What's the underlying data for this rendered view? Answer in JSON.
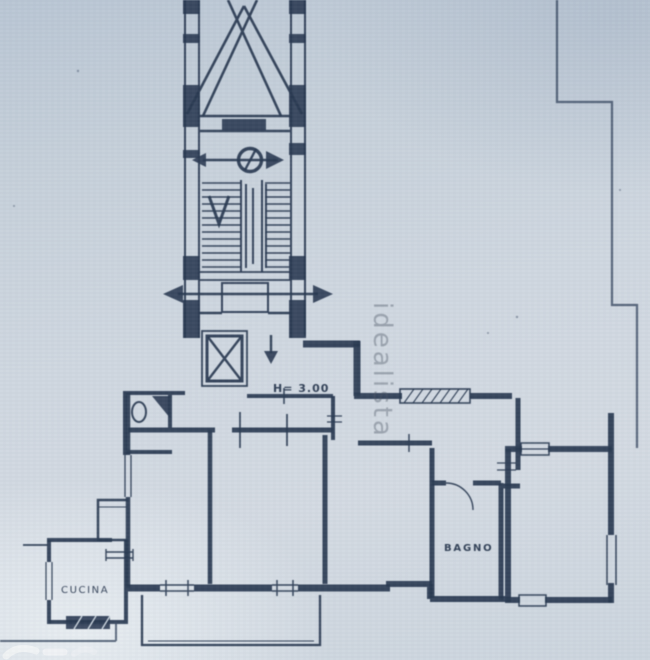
{
  "meta": {
    "description": "Scanned photo of an Italian apartment floor plan (planimetria) with stairwell and elevator tower",
    "domain_guess": "real-estate listing floor plan"
  },
  "colors": {
    "paper": "#cbd5de",
    "ink": "#2a3a52",
    "watermark_grey": "#4b5563",
    "logo_white": "#f2f4f6"
  },
  "labels": {
    "kitchen": "CUCINA",
    "bathroom": "BAGNO",
    "height_note": "H= 3.00"
  },
  "watermark": {
    "text": "idealista",
    "orientation": "rotated-90-vertical"
  },
  "symbols": [
    "north-circle-arrow",
    "stair-down-arrow",
    "corridor-double-arrow",
    "elevator-x-brace",
    "entry-down-arrow",
    "toilet-fixture",
    "window-hatch"
  ]
}
